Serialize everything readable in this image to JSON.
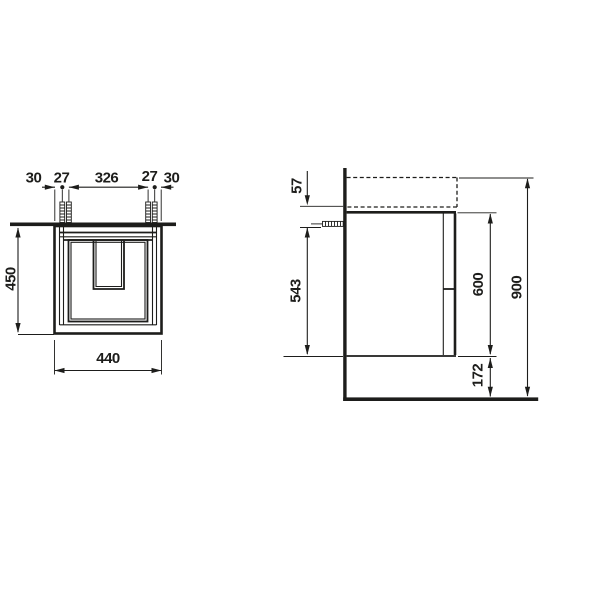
{
  "drawing": {
    "type": "technical-dimension-drawing",
    "views": {
      "front": {
        "top_dims": [
          "30",
          "27",
          "326",
          "27",
          "30"
        ],
        "width": "440",
        "height": "450"
      },
      "side": {
        "offset_top": "57",
        "screw_to_bottom": "543",
        "body_height": "600",
        "total_height": "900",
        "floor_clearance": "172"
      }
    },
    "colors": {
      "line": "#1d1d1b",
      "background": "#ffffff"
    }
  }
}
